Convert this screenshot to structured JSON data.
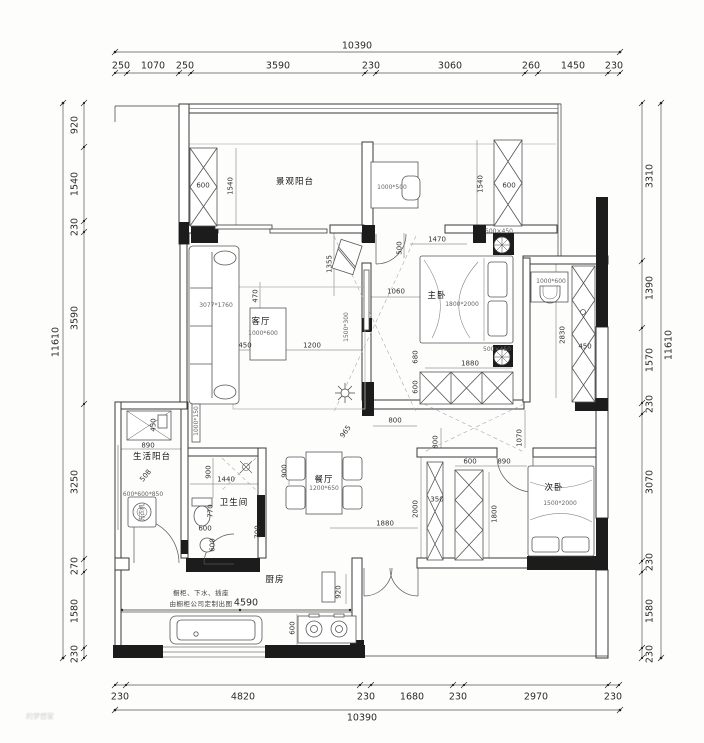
{
  "drawing": {
    "kind": "apartment-floor-plan",
    "units": "mm",
    "overall_width": "10390",
    "overall_height": "11610"
  },
  "dim_chains": {
    "top": {
      "total": "10390",
      "segments": [
        "250",
        "1070",
        "250",
        "3590",
        "230",
        "3060",
        "260",
        "1450",
        "230"
      ]
    },
    "bottom": {
      "total": "10390",
      "segments": [
        "230",
        "4820",
        "230",
        "1680",
        "230",
        "2970",
        "230"
      ]
    },
    "left": {
      "total": "11610",
      "segments": [
        "920",
        "1540",
        "230",
        "3590",
        "3250",
        "270",
        "1580",
        "230"
      ]
    },
    "right": {
      "total": "11610",
      "segments": [
        "3310",
        "1390",
        "1570",
        "230",
        "3070",
        "230",
        "1580",
        "230"
      ]
    }
  },
  "rooms": [
    "景观阳台",
    "客厅",
    "餐厅",
    "厨房",
    "卫生间",
    "生活阳台",
    "主卧",
    "次卧"
  ],
  "furniture_sizes": {
    "sofa": "3077*1760",
    "coffee_table": "1000*600",
    "tv": "1500*300",
    "desk": "1000*500",
    "master_bed": "1800*2000",
    "second_bed": "1500*2000",
    "dining_table": "1200*650",
    "basin_counter": "1000*600",
    "wall_cabinet": "1000*150",
    "washing_machine": "600*600*850",
    "plant_box": "500×450"
  },
  "notes": {
    "kitchen_line1": "橱柜、下水、插座",
    "kitchen_line2": "由橱柜公司定制出图",
    "kitchen_counter_dim": "4590"
  },
  "watermark": "的梦想家",
  "annotations": [
    {
      "t": "10390",
      "x": 357,
      "y": 46,
      "c": "dim",
      "n": "dim-top-total"
    },
    {
      "t": "250",
      "x": 121,
      "y": 66,
      "c": "dim"
    },
    {
      "t": "1070",
      "x": 153,
      "y": 66,
      "c": "dim"
    },
    {
      "t": "250",
      "x": 185,
      "y": 66,
      "c": "dim"
    },
    {
      "t": "3590",
      "x": 278,
      "y": 66,
      "c": "dim"
    },
    {
      "t": "230",
      "x": 371,
      "y": 66,
      "c": "dim"
    },
    {
      "t": "3060",
      "x": 450,
      "y": 66,
      "c": "dim"
    },
    {
      "t": "260",
      "x": 531,
      "y": 66,
      "c": "dim"
    },
    {
      "t": "1450",
      "x": 573,
      "y": 66,
      "c": "dim"
    },
    {
      "t": "230",
      "x": 614,
      "y": 66,
      "c": "dim"
    },
    {
      "t": "230",
      "x": 120,
      "y": 697,
      "c": "dim"
    },
    {
      "t": "4820",
      "x": 243,
      "y": 697,
      "c": "dim"
    },
    {
      "t": "230",
      "x": 366,
      "y": 697,
      "c": "dim"
    },
    {
      "t": "1680",
      "x": 412,
      "y": 697,
      "c": "dim"
    },
    {
      "t": "230",
      "x": 458,
      "y": 697,
      "c": "dim"
    },
    {
      "t": "2970",
      "x": 536,
      "y": 697,
      "c": "dim"
    },
    {
      "t": "230",
      "x": 613,
      "y": 697,
      "c": "dim"
    },
    {
      "t": "10390",
      "x": 362,
      "y": 718,
      "c": "dim",
      "n": "dim-bottom-total"
    },
    {
      "t": "920",
      "x": 75,
      "y": 125,
      "r": -90,
      "c": "dim"
    },
    {
      "t": "1540",
      "x": 75,
      "y": 184,
      "r": -90,
      "c": "dim"
    },
    {
      "t": "230",
      "x": 75,
      "y": 227,
      "r": -90,
      "c": "dim"
    },
    {
      "t": "3590",
      "x": 75,
      "y": 318,
      "r": -90,
      "c": "dim"
    },
    {
      "t": "3250",
      "x": 75,
      "y": 482,
      "r": -90,
      "c": "dim"
    },
    {
      "t": "270",
      "x": 75,
      "y": 566,
      "r": -90,
      "c": "dim"
    },
    {
      "t": "1580",
      "x": 75,
      "y": 611,
      "r": -90,
      "c": "dim"
    },
    {
      "t": "230",
      "x": 75,
      "y": 654,
      "r": -90,
      "c": "dim"
    },
    {
      "t": "11610",
      "x": 56,
      "y": 342,
      "r": -90,
      "c": "dim",
      "n": "dim-left-total"
    },
    {
      "t": "3310",
      "x": 650,
      "y": 176,
      "r": -90,
      "c": "dim"
    },
    {
      "t": "1390",
      "x": 650,
      "y": 288,
      "r": -90,
      "c": "dim"
    },
    {
      "t": "1570",
      "x": 650,
      "y": 360,
      "r": -90,
      "c": "dim"
    },
    {
      "t": "230",
      "x": 650,
      "y": 404,
      "r": -90,
      "c": "dim"
    },
    {
      "t": "3070",
      "x": 650,
      "y": 482,
      "r": -90,
      "c": "dim"
    },
    {
      "t": "230",
      "x": 650,
      "y": 562,
      "r": -90,
      "c": "dim"
    },
    {
      "t": "1580",
      "x": 650,
      "y": 611,
      "r": -90,
      "c": "dim"
    },
    {
      "t": "230",
      "x": 650,
      "y": 654,
      "r": -90,
      "c": "dim"
    },
    {
      "t": "11610",
      "x": 669,
      "y": 345,
      "r": -90,
      "c": "dim",
      "n": "dim-right-total"
    },
    {
      "t": "景观阳台",
      "x": 295,
      "y": 182,
      "c": "room",
      "n": "room-label-view-balcony"
    },
    {
      "t": "客厅",
      "x": 261,
      "y": 322,
      "c": "room",
      "n": "room-label-living"
    },
    {
      "t": "餐厅",
      "x": 324,
      "y": 480,
      "c": "room",
      "n": "room-label-dining"
    },
    {
      "t": "主卧",
      "x": 437,
      "y": 296,
      "c": "room",
      "n": "room-label-master-bedroom"
    },
    {
      "t": "次卧",
      "x": 554,
      "y": 488,
      "c": "room",
      "n": "room-label-second-bedroom"
    },
    {
      "t": "卫生间",
      "x": 234,
      "y": 503,
      "c": "room",
      "n": "room-label-bathroom"
    },
    {
      "t": "生活阳台",
      "x": 152,
      "y": 457,
      "c": "room",
      "n": "room-label-service-balcony"
    },
    {
      "t": "厨房",
      "x": 275,
      "y": 580,
      "c": "room",
      "n": "room-label-kitchen"
    },
    {
      "t": "3077*1760",
      "x": 216,
      "y": 306,
      "c": "tiny"
    },
    {
      "t": "1000*600",
      "x": 263,
      "y": 334,
      "c": "tiny"
    },
    {
      "t": "1500*300",
      "x": 347,
      "y": 327,
      "r": -90,
      "c": "tiny"
    },
    {
      "t": "1000*500",
      "x": 392,
      "y": 188,
      "c": "tiny"
    },
    {
      "t": "1800*2000",
      "x": 462,
      "y": 305,
      "c": "tiny"
    },
    {
      "t": "500×450",
      "x": 499,
      "y": 232,
      "c": "tiny"
    },
    {
      "t": "500×450",
      "x": 497,
      "y": 350,
      "c": "tiny"
    },
    {
      "t": "1000*600",
      "x": 551,
      "y": 282,
      "c": "tiny"
    },
    {
      "t": "1500*2000",
      "x": 560,
      "y": 504,
      "c": "tiny"
    },
    {
      "t": "1200*650",
      "x": 324,
      "y": 489,
      "c": "tiny"
    },
    {
      "t": "1000*150",
      "x": 197,
      "y": 421,
      "r": -90,
      "c": "tiny"
    },
    {
      "t": "600*600*850",
      "x": 143,
      "y": 495,
      "c": "tiny"
    },
    {
      "t": "洗衣机",
      "x": 143,
      "y": 513,
      "r": -90,
      "c": "tiny",
      "n": "washing-machine-label"
    },
    {
      "t": "600",
      "x": 203,
      "y": 186,
      "c": "dim2"
    },
    {
      "t": "1540",
      "x": 231,
      "y": 186,
      "r": -90,
      "c": "dim2"
    },
    {
      "t": "1540",
      "x": 481,
      "y": 184,
      "r": -90,
      "c": "dim2"
    },
    {
      "t": "600",
      "x": 509,
      "y": 186,
      "c": "dim2"
    },
    {
      "t": "1470",
      "x": 437,
      "y": 240,
      "c": "dim2"
    },
    {
      "t": "500",
      "x": 400,
      "y": 248,
      "r": -90,
      "c": "dim2"
    },
    {
      "t": "1355",
      "x": 330,
      "y": 264,
      "r": -90,
      "c": "dim2"
    },
    {
      "t": "1060",
      "x": 396,
      "y": 292,
      "c": "dim2"
    },
    {
      "t": "470",
      "x": 256,
      "y": 296,
      "r": -90,
      "c": "dim2"
    },
    {
      "t": "450",
      "x": 245,
      "y": 346,
      "c": "dim2"
    },
    {
      "t": "1200",
      "x": 312,
      "y": 346,
      "c": "dim2"
    },
    {
      "t": "680",
      "x": 416,
      "y": 357,
      "r": -90,
      "c": "dim2"
    },
    {
      "t": "1880",
      "x": 470,
      "y": 364,
      "c": "dim2"
    },
    {
      "t": "600",
      "x": 416,
      "y": 387,
      "r": -90,
      "c": "dim2"
    },
    {
      "t": "2830",
      "x": 563,
      "y": 335,
      "r": -90,
      "c": "dim2"
    },
    {
      "t": "450",
      "x": 585,
      "y": 347,
      "c": "dim2"
    },
    {
      "t": "800",
      "x": 395,
      "y": 421,
      "c": "dim2"
    },
    {
      "t": "800",
      "x": 436,
      "y": 442,
      "r": -90,
      "c": "dim2"
    },
    {
      "t": "1070",
      "x": 520,
      "y": 438,
      "r": -90,
      "c": "dim2"
    },
    {
      "t": "965",
      "x": 346,
      "y": 432,
      "r": -55,
      "c": "dim2"
    },
    {
      "t": "900",
      "x": 285,
      "y": 471,
      "r": -90,
      "c": "dim2"
    },
    {
      "t": "900",
      "x": 209,
      "y": 472,
      "r": -90,
      "c": "dim2"
    },
    {
      "t": "1440",
      "x": 226,
      "y": 480,
      "c": "dim2"
    },
    {
      "t": "770",
      "x": 211,
      "y": 511,
      "r": -90,
      "c": "dim2"
    },
    {
      "t": "600",
      "x": 205,
      "y": 529,
      "c": "dim2"
    },
    {
      "t": "600",
      "x": 213,
      "y": 545,
      "r": -90,
      "c": "dim2"
    },
    {
      "t": "700",
      "x": 258,
      "y": 532,
      "r": -90,
      "c": "dim2"
    },
    {
      "t": "450",
      "x": 154,
      "y": 425,
      "r": -90,
      "c": "dim2"
    },
    {
      "t": "890",
      "x": 148,
      "y": 446,
      "c": "dim2"
    },
    {
      "t": "508",
      "x": 146,
      "y": 476,
      "r": -50,
      "c": "dim2"
    },
    {
      "t": "600",
      "x": 470,
      "y": 462,
      "c": "dim2"
    },
    {
      "t": "890",
      "x": 504,
      "y": 462,
      "c": "dim2"
    },
    {
      "t": "1800",
      "x": 495,
      "y": 514,
      "r": -90,
      "c": "dim2"
    },
    {
      "t": "350",
      "x": 437,
      "y": 500,
      "c": "dim2"
    },
    {
      "t": "2000",
      "x": 416,
      "y": 509,
      "r": -90,
      "c": "dim2"
    },
    {
      "t": "1880",
      "x": 385,
      "y": 524,
      "c": "dim2"
    },
    {
      "t": "920",
      "x": 339,
      "y": 592,
      "r": -90,
      "c": "dim2"
    },
    {
      "t": "4590",
      "x": 246,
      "y": 603,
      "c": "dim",
      "n": "kitchen-counter-dim"
    },
    {
      "t": "600",
      "x": 293,
      "y": 628,
      "r": -90,
      "c": "dim2"
    },
    {
      "t": "橱柜、下水、插座",
      "x": 201,
      "y": 593,
      "c": "note",
      "n": "kitchen-note-1"
    },
    {
      "t": "由橱柜公司定制出图",
      "x": 201,
      "y": 604,
      "c": "note",
      "n": "kitchen-note-2"
    },
    {
      "t": "的梦想家",
      "x": 40,
      "y": 717,
      "c": "wm",
      "n": "watermark"
    }
  ]
}
